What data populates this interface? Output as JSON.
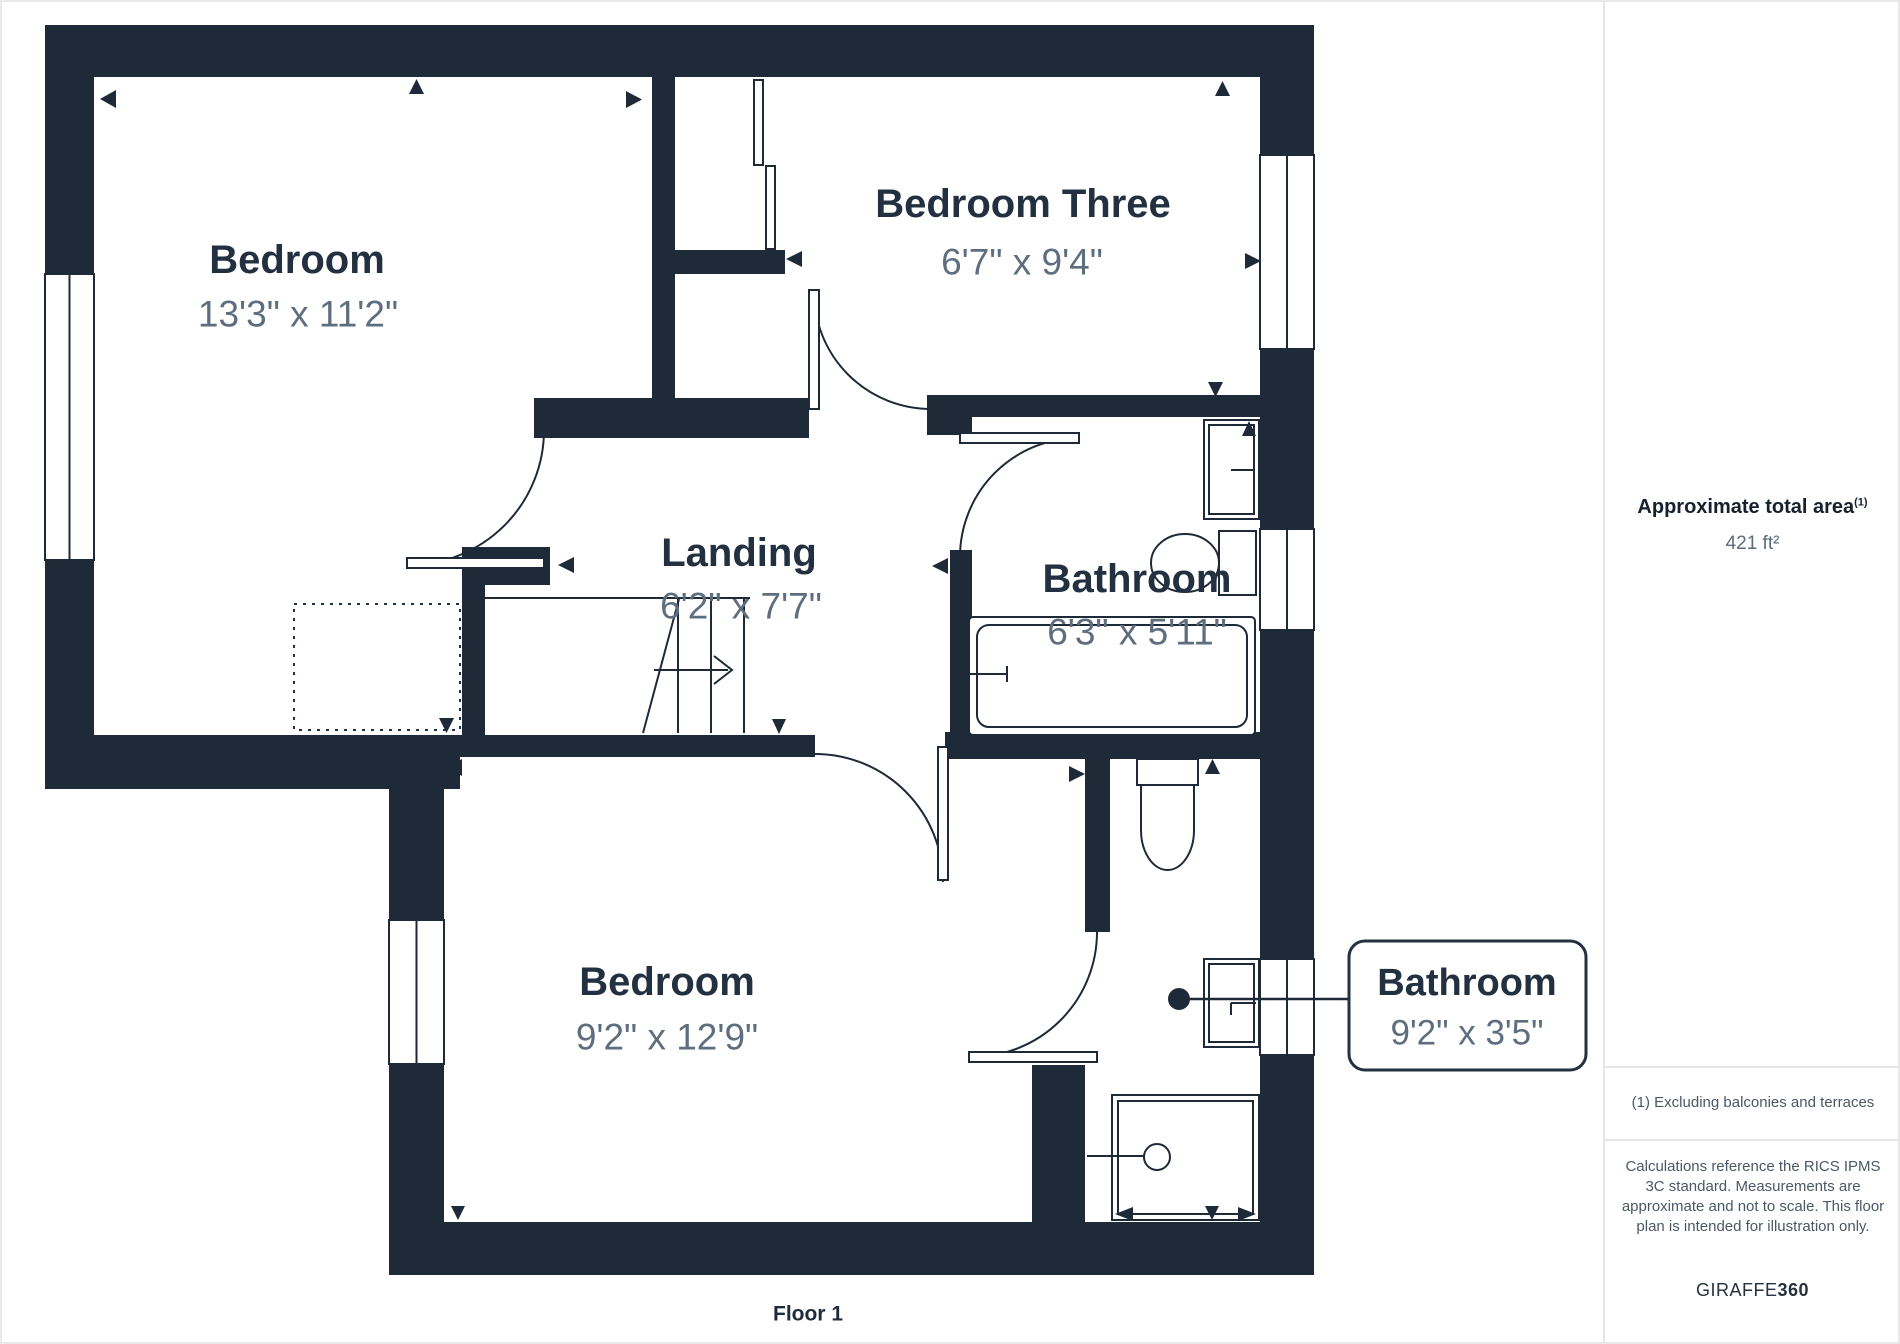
{
  "plan": {
    "rooms": [
      {
        "name": "Bedroom",
        "dims": "13'3\" x 11'2\""
      },
      {
        "name": "Bedroom Three",
        "dims": "6'7\" x 9'4\""
      },
      {
        "name": "Landing",
        "dims": "6'2\" x 7'7\""
      },
      {
        "name": "Bathroom",
        "dims": "6'3\" x 5'11\""
      },
      {
        "name": "Bedroom",
        "dims": "9'2\" x 12'9\""
      }
    ],
    "callout": {
      "name": "Bathroom",
      "dims": "9'2\" x 3'5\""
    },
    "floor_label": "Floor 1",
    "wall_color": "#1f2a38",
    "icons": {
      "viewpoint_marker": "▲ small filled triangle markers placed beside walls",
      "stair_direction_arrow": "→ open chevron on stair run",
      "callout_point": "● filled dot with leader line"
    }
  },
  "sidebar": {
    "area_title": "Approximate total area",
    "area_title_sup": "(1)",
    "area_value": "421 ft²",
    "footnote": "(1) Excluding balconies and terraces",
    "disclaimer": "Calculations reference the RICS IPMS 3C standard. Measurements are approximate and not to scale. This floor plan is intended for illustration only.",
    "brand_name": "GIRAFFE",
    "brand_suffix": "360"
  }
}
